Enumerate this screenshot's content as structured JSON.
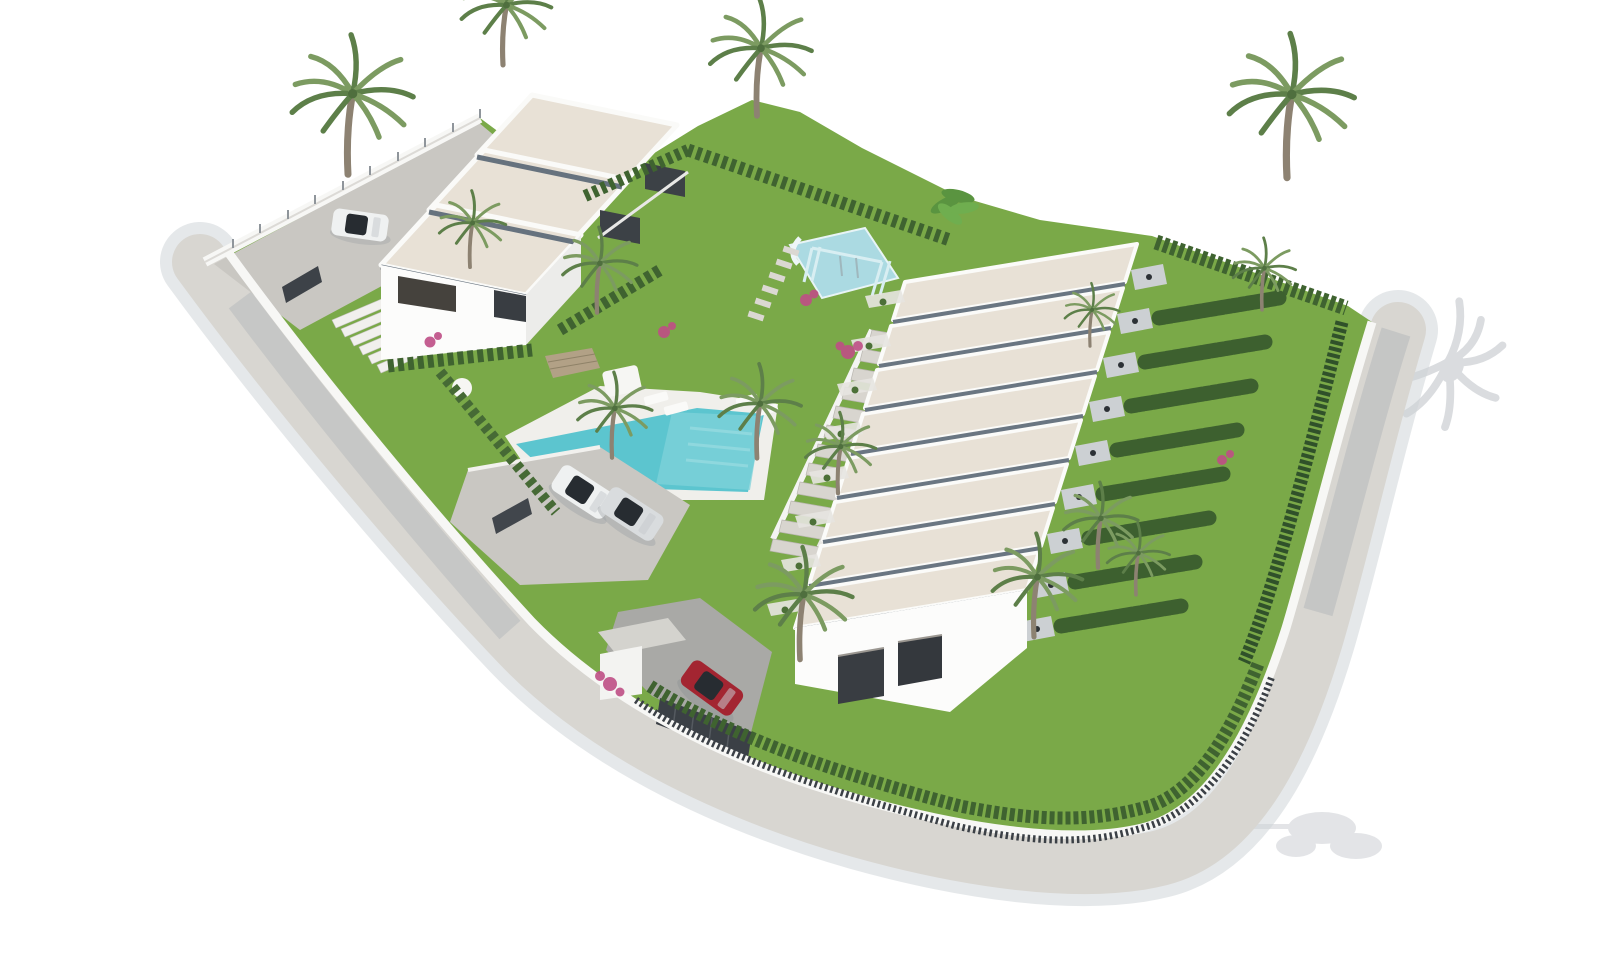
{
  "meta": {
    "type": "3d-architectural-aerial-render",
    "subject": "Aerial isometric render of a white modern residential development with a stepped villa block, a diagonal row of terraced townhouses, swimming pool, playground, gardens and palm trees",
    "canvas": {
      "width": 1600,
      "height": 960
    }
  },
  "scene": {
    "colors": {
      "background": "#ffffff",
      "road": "#d8d6d1",
      "road_shadow": "#ccd1d5",
      "road_dark": "#b2b6b9",
      "paving": "#c9c7c2",
      "inner_drive": "#a9a9a6",
      "wall_white": "#f7f7f5",
      "roof_beige": "#e8e1d6",
      "roof_fascia": "#66727e",
      "facade_white": "#fcfcfb",
      "facade_shadow": "#ececea",
      "window_dark": "#393d42",
      "grass": "#7aa948",
      "hedge": "#3f6330",
      "hedge_dark": "#30512a",
      "palm_frond": "#7c9b61",
      "palm_frond_dark": "#5d7f49",
      "palm_trunk": "#8d8272",
      "pool_water": "#5cc5cf",
      "pool_light": "#7fd2da",
      "deck_white": "#f0efeb",
      "playground_blue": "#abdae2",
      "car_white": "#eff1f1",
      "car_silver": "#d9dcde",
      "car_red": "#a32531",
      "fence_dark": "#3b4046",
      "stone_wall": "#b2a186",
      "flower_pink": "#bf4f86",
      "shadow_gray": "#b6bbc1"
    },
    "inventory": {
      "villa_block_units": 3,
      "townhouse_roof_strips": 8,
      "townhouse_front_house": 1,
      "swimming_pools": 1,
      "playgrounds": 1,
      "cars_total": 4,
      "car_colors": [
        "white",
        "white",
        "silver",
        "red"
      ],
      "palm_trees_approx": 15,
      "entrance_gates": 3
    },
    "objects": [
      {
        "name": "villa-building",
        "description": "three stepped two-storey units with flat beige gravel roofs, upper left"
      },
      {
        "name": "townhouse-row",
        "description": "terraced row of units with parallel beige flat roofs stepping down diagonally, center right"
      },
      {
        "name": "swimming-pool",
        "description": "turquoise pool with white deck, sun loungers and parasol"
      },
      {
        "name": "playground",
        "description": "light-blue soft surface with swing frame and slide, upper center garden"
      },
      {
        "name": "parking-area",
        "description": "paved parking with one white and one silver car"
      },
      {
        "name": "entrance-gate",
        "description": "dark sliding gate with red car entering, bottom center"
      },
      {
        "name": "perimeter-road",
        "description": "light gray sidewalk band sweeping around left, bottom and right of the plot"
      },
      {
        "name": "back-gardens",
        "description": "private lawns separated by tall conifer hedges on the right side"
      }
    ]
  }
}
